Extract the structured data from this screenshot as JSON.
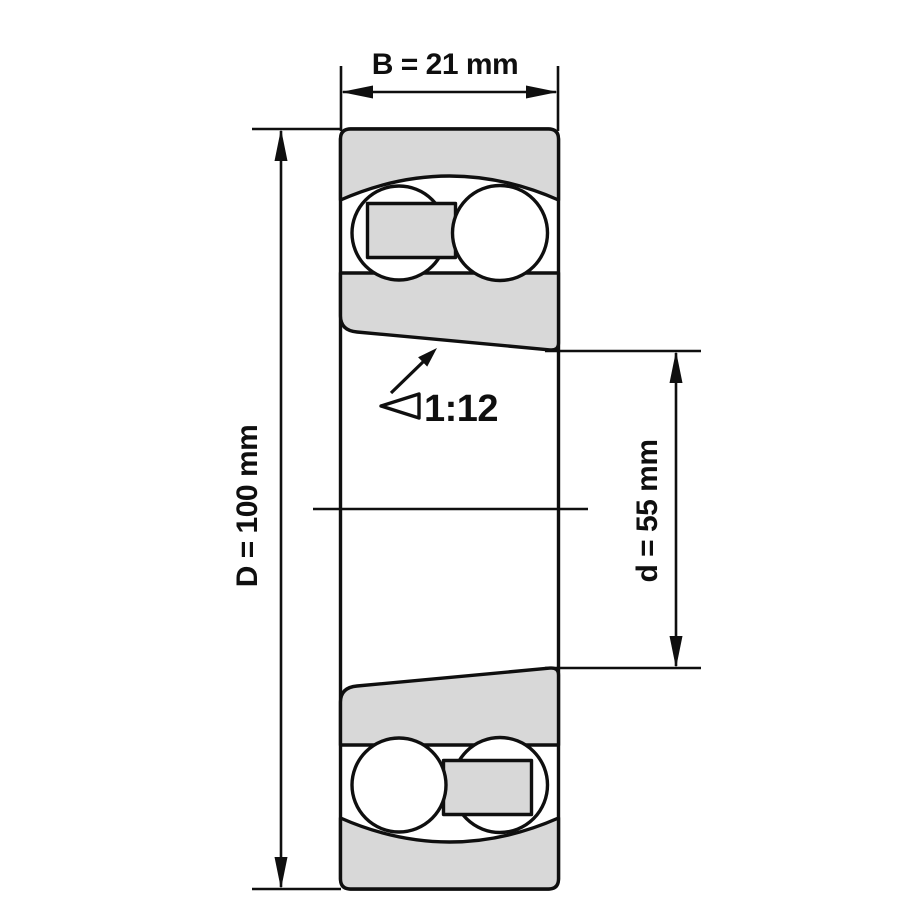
{
  "drawing": {
    "kind": "bearing-cross-section",
    "dimensions": {
      "width": {
        "label": "B = 21 mm",
        "symbol": "B",
        "value": 21,
        "unit": "mm"
      },
      "outer_diameter": {
        "label": "D = 100 mm",
        "symbol": "D",
        "value": 100,
        "unit": "mm"
      },
      "bore_diameter": {
        "label": "d = 55 mm",
        "symbol": "d",
        "value": 55,
        "unit": "mm"
      },
      "taper": {
        "label": "1:12"
      }
    },
    "colors": {
      "ring_fill": "#d8d8d8",
      "line": "#0f0f0f",
      "background": "#ffffff"
    }
  }
}
